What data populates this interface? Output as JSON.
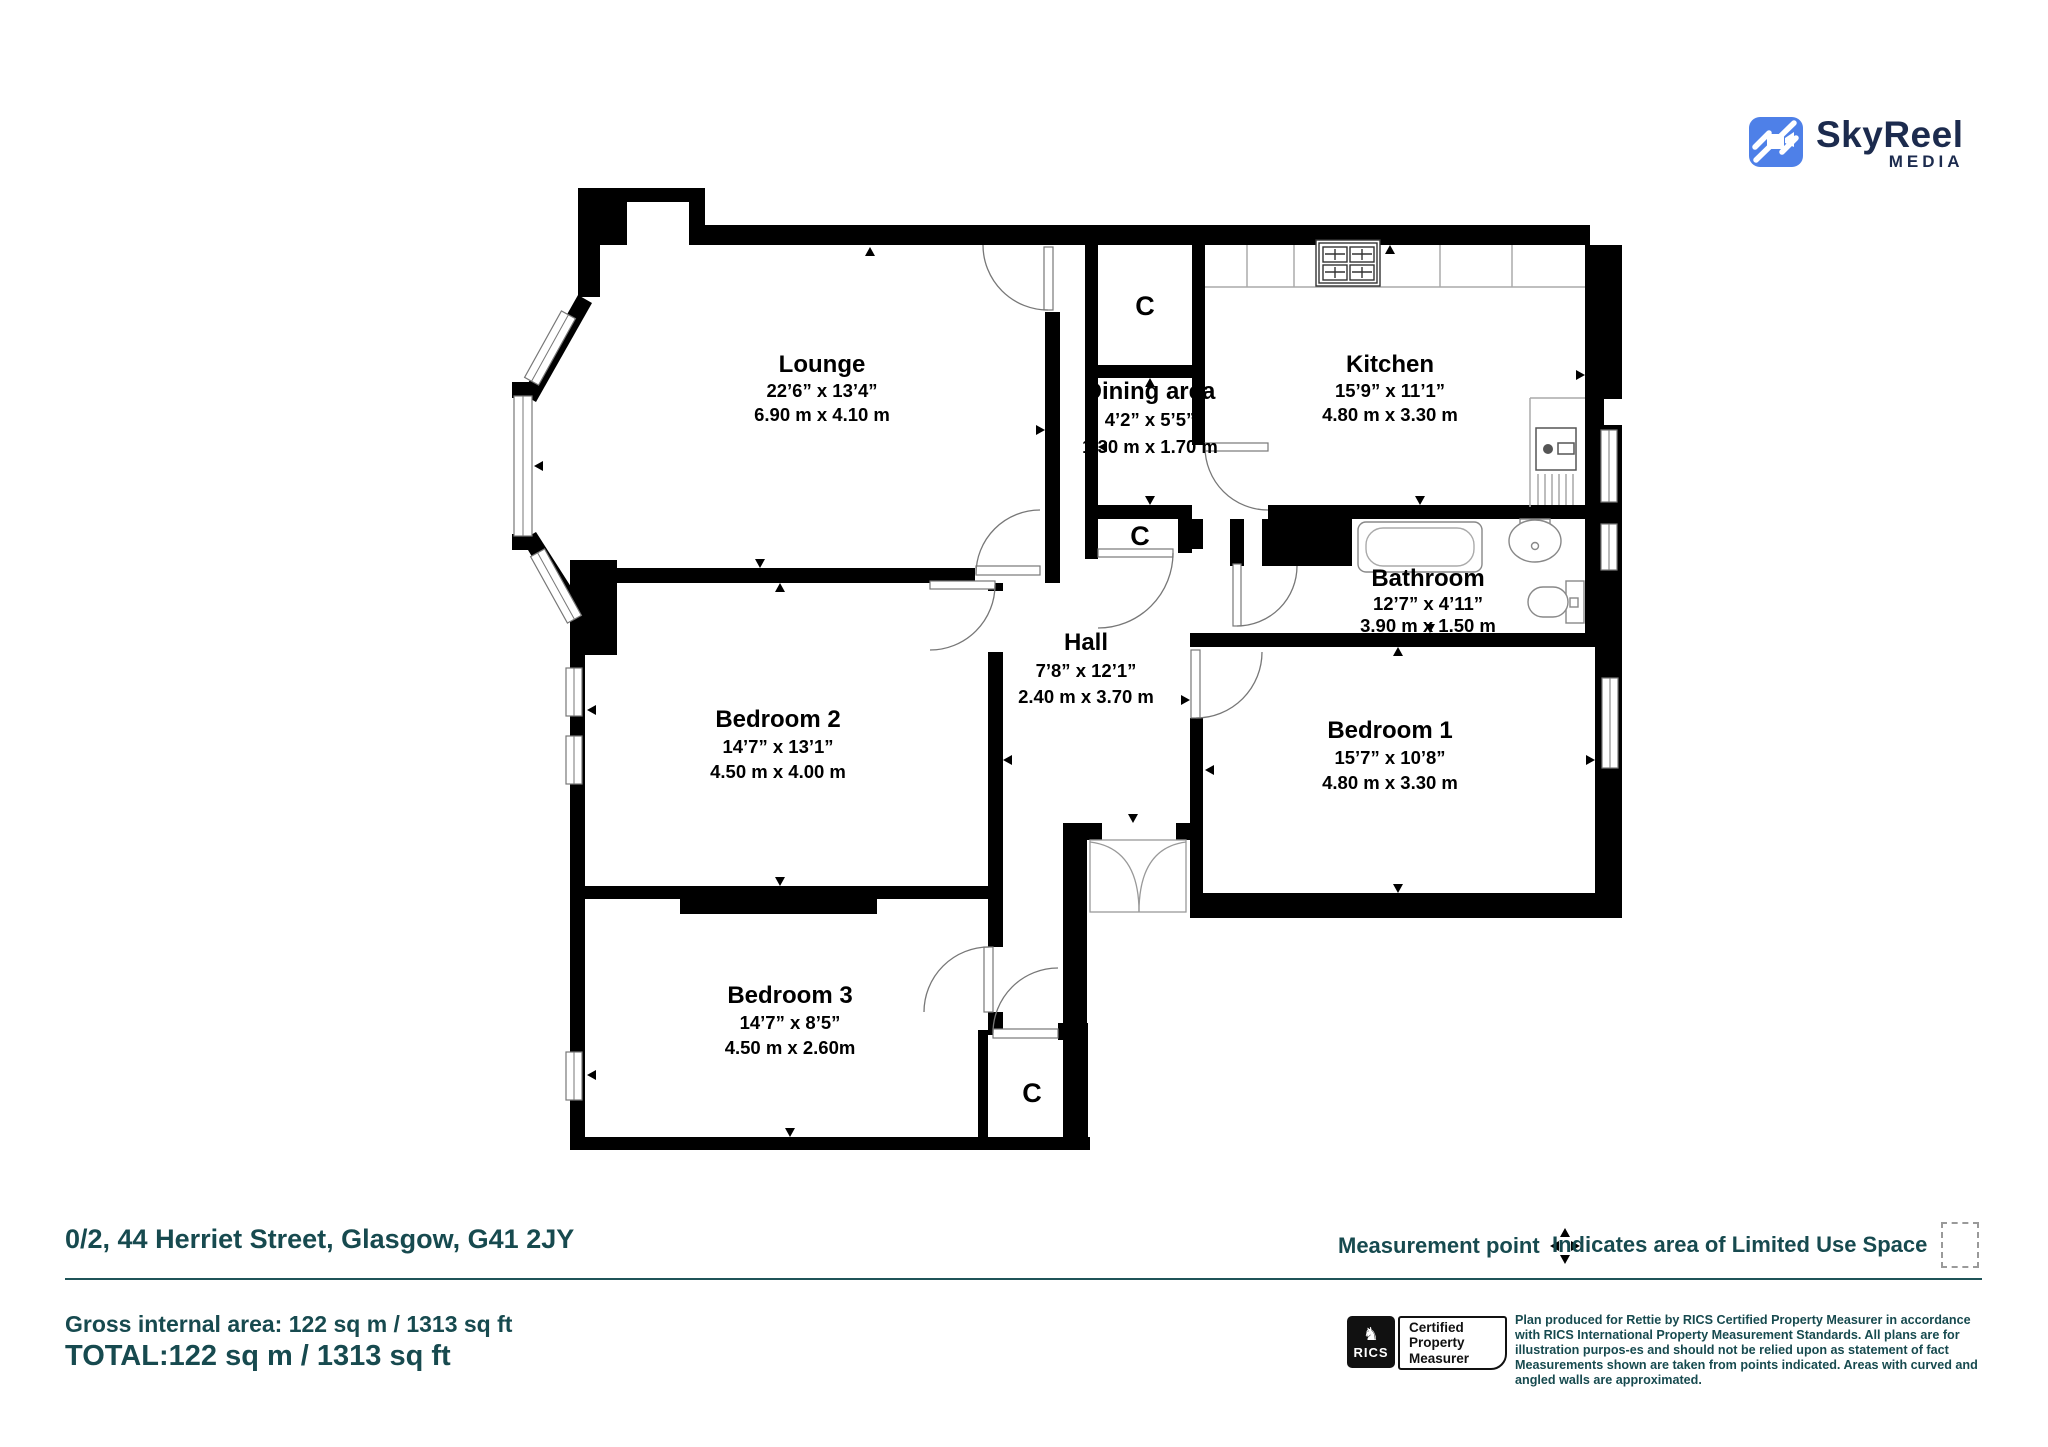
{
  "brand": {
    "name": "SkyReel",
    "sub": "MEDIA"
  },
  "plan": {
    "rooms": [
      {
        "key": "lounge",
        "name": "Lounge",
        "imperial": "22’6” x 13’4”",
        "metric": "6.90 m x 4.10 m"
      },
      {
        "key": "dining",
        "name": "Dining area",
        "imperial": "4’2” x 5’5”",
        "metric": "1.30 m x 1.70 m"
      },
      {
        "key": "kitchen",
        "name": "Kitchen",
        "imperial": "15’9” x 11’1”",
        "metric": "4.80 m x 3.30 m"
      },
      {
        "key": "bathroom",
        "name": "Bathroom",
        "imperial": "12’7” x 4’11”",
        "metric": "3.90 m x 1.50 m"
      },
      {
        "key": "hall",
        "name": "Hall",
        "imperial": "7’8” x 12’1”",
        "metric": "2.40 m x 3.70 m"
      },
      {
        "key": "bedroom1",
        "name": "Bedroom 1",
        "imperial": "15’7” x 10’8”",
        "metric": "4.80 m x 3.30 m"
      },
      {
        "key": "bedroom2",
        "name": "Bedroom 2",
        "imperial": "14’7” x 13’1”",
        "metric": "4.50 m x 4.00 m"
      },
      {
        "key": "bedroom3",
        "name": "Bedroom 3",
        "imperial": "14’7” x 8’5”",
        "metric": "4.50 m x 2.60m"
      }
    ],
    "closet_label": "C"
  },
  "footer": {
    "address": "0/2, 44 Herriet Street, Glasgow, G41 2JY",
    "measurement_point_label": "Measurement point",
    "limited_use_label": "Indicates area of  Limited Use Space",
    "gross_area": "Gross internal area: 122 sq m / 1313 sq ft",
    "total": "TOTAL:122 sq m / 1313 sq ft"
  },
  "certification": {
    "rics": "RICS",
    "badge_lines": [
      "Certified",
      "Property",
      "Measurer"
    ],
    "disclaimer": "Plan produced for Rettie by RICS Certified Property Measurer in accordance with RICS International Property  Measurement Standards.  All plans are for illustration purpos-es and should not be relied upon as statement of fact Measurements shown are taken from points indicated. Areas with curved and angled walls are approximated."
  },
  "colors": {
    "teal": "#174A4F",
    "logo_blue": "#4E80E8",
    "logo_navy": "#1C2B4E"
  }
}
